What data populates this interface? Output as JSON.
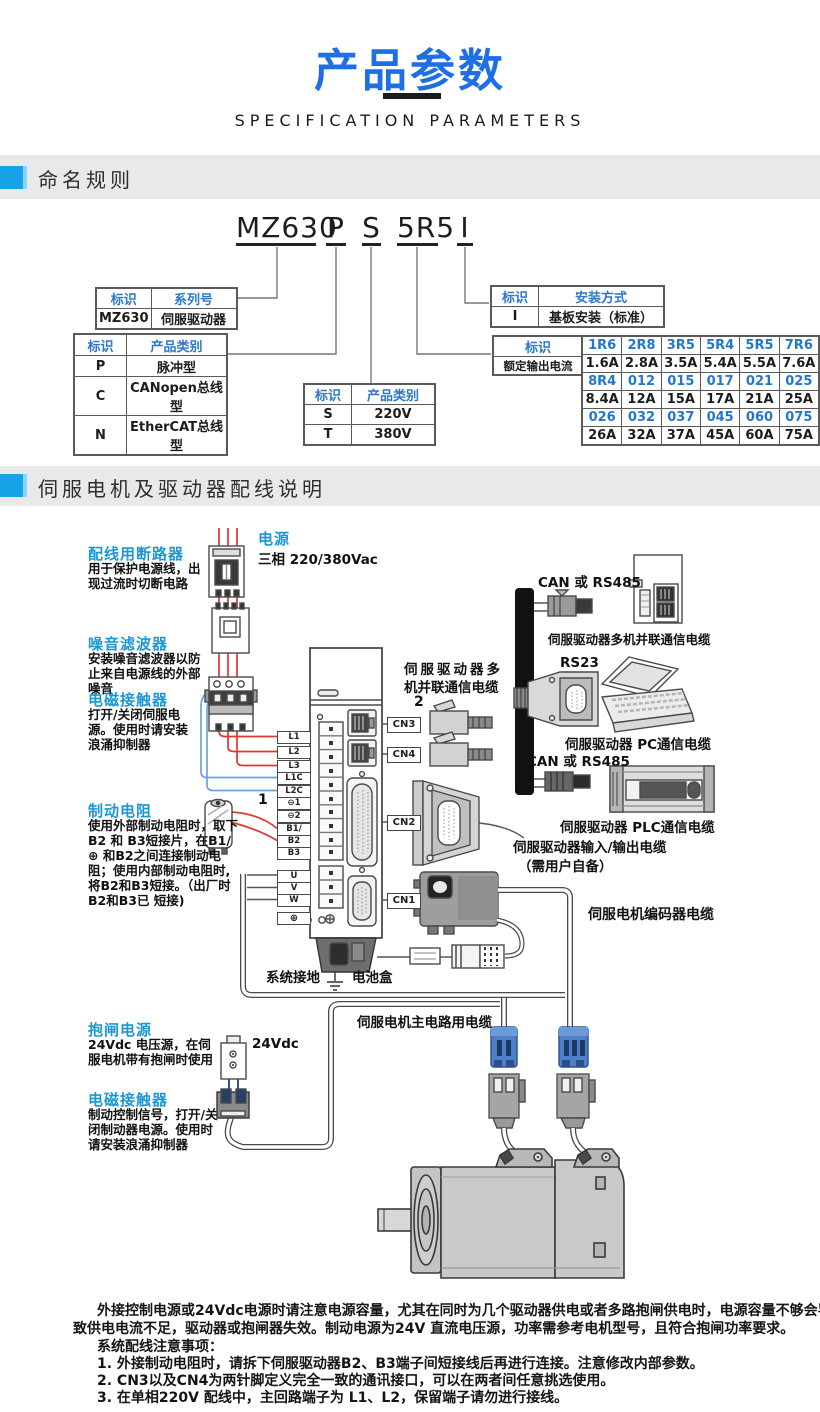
{
  "header": {
    "title": "产品参数",
    "subtitle": "SPECIFICATION PARAMETERS"
  },
  "sections": {
    "naming": "命名规则",
    "wiring": "伺服电机及驱动器配线说明"
  },
  "model_code": {
    "series": "MZ630",
    "type": "P",
    "voltage": "S",
    "current": "5R5",
    "mount": "I"
  },
  "naming_tables": {
    "series": {
      "headers": [
        "标识",
        "系列号"
      ],
      "row": [
        "MZ630",
        "伺服驱动器"
      ]
    },
    "type": {
      "headers": [
        "标识",
        "产品类别"
      ],
      "rows": [
        [
          "P",
          "脉冲型"
        ],
        [
          "C",
          "CANopen总线型"
        ],
        [
          "N",
          "EtherCAT总线型"
        ]
      ]
    },
    "voltage": {
      "headers": [
        "标识",
        "产品类别"
      ],
      "rows": [
        [
          "S",
          "220V"
        ],
        [
          "T",
          "380V"
        ]
      ]
    },
    "mounting": {
      "headers": [
        "标识",
        "安装方式"
      ],
      "row": [
        "I",
        "基板安装（标准）"
      ]
    },
    "current": {
      "label_header": "标识",
      "label": "额定输出电流",
      "grid": [
        [
          "1R6",
          "2R8",
          "3R5",
          "5R4",
          "5R5",
          "7R6"
        ],
        [
          "1.6A",
          "2.8A",
          "3.5A",
          "5.4A",
          "5.5A",
          "7.6A"
        ],
        [
          "8R4",
          "012",
          "015",
          "017",
          "021",
          "025"
        ],
        [
          "8.4A",
          "12A",
          "15A",
          "17A",
          "21A",
          "25A"
        ],
        [
          "026",
          "032",
          "037",
          "045",
          "060",
          "075"
        ],
        [
          "26A",
          "32A",
          "37A",
          "45A",
          "60A",
          "75A"
        ]
      ]
    }
  },
  "diagram": {
    "power_title": "电源",
    "power_desc": "三相 220/380Vac",
    "breaker_title": "配线用断路器",
    "breaker_desc": "用于保护电源线，出现过流时切断电路",
    "filter_title": "噪音滤波器",
    "filter_desc": "安装噪音滤波器以防止来自电源线的外部噪音",
    "contactor_title": "电磁接触器",
    "contactor_desc": "打开/关闭伺服电源。使用时请安装浪涌抑制器",
    "resistor_title": "制动电阻",
    "resistor_desc": "使用外部制动电阻时，取下 B2 和 B3短接片，在B1/⊕ 和B2之间连接制动电阻；使用内部制动电阻时,将B2和B3短接。（出厂时B2和B3已 短接)",
    "brake_power_title": "抱闸电源",
    "brake_power_desc": "24Vdc 电压源，在伺服电机带有抱闸时使用",
    "brake_contactor_title": "电磁接触器",
    "brake_contactor_desc": "制动控制信号，打开/关闭制动器电源。使用时请安装浪涌抑制器",
    "label_24vdc": "24Vdc",
    "callout_1": "1",
    "callout_2": "2",
    "can_rs485_top": "CAN 或 RS485",
    "can_rs485_bottom": "CAN 或 RS485",
    "rs23": "RS23",
    "multi_cable_right": "伺服驱动器多机并联通信电缆",
    "multi_cable_left_1": "伺服驱动器多",
    "multi_cable_left_2": "机并联通信电缆",
    "pc_cable": "伺服驱动器 PC通信电缆",
    "plc_cable": "伺服驱动器 PLC通信电缆",
    "io_cable_1": "伺服驱动器输入/输出电缆",
    "io_cable_2": "（需用户自备）",
    "encoder_cable": "伺服电机编码器电缆",
    "main_cable": "伺服电机主电路用电缆",
    "ground": "系统接地",
    "battery": "电池盒",
    "connectors": {
      "cn1": "CN1",
      "cn2": "CN2",
      "cn3": "CN3",
      "cn4": "CN4"
    },
    "terminals": [
      "L1",
      "L2",
      "L3",
      "L1C",
      "L2C",
      "⊖1",
      "⊖2",
      "B1/",
      "B2",
      "B3",
      "U",
      "V",
      "W",
      "⊕"
    ]
  },
  "notes": {
    "l1": "外接控制电源或24Vdc电源时请注意电源容量，尤其在同时为几个驱动器供电或者多路抱闸供电时，电源容量不够会导",
    "l2": "致供电电流不足，驱动器或抱闸器失效。制动电源为24V 直流电压源，功率需参考电机型号，且符合抱闸功率要求。",
    "l3": "系统配线注意事项：",
    "l4": "1. 外接制动电阻时，请拆下伺服驱动器B2、B3端子间短接线后再进行连接。注意修改内部参数。",
    "l5": "2. CN3以及CN4为两针脚定义完全一致的通讯接口，可以在两者间任意挑选使用。",
    "l6": "3. 在单相220V 配线中，主回路端子为 L1、L2，保留端子请勿进行接线。"
  },
  "colors": {
    "accent_blue": "#1e6ee8",
    "section_blue": "#18a3e8",
    "label_blue": "#1d97d4",
    "table_head_blue": "#2e77c9",
    "wire_red": "#e0372e",
    "wire_blue": "#6aa3dc"
  }
}
